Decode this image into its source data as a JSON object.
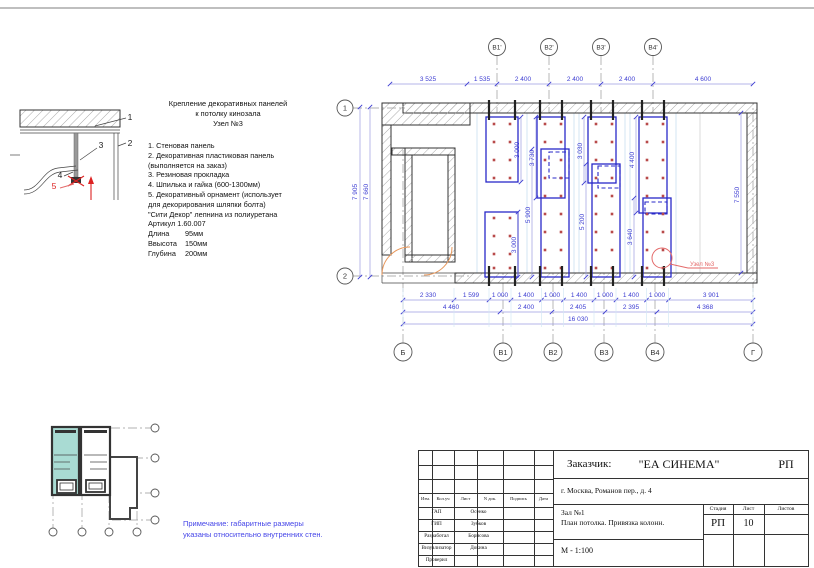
{
  "detail": {
    "title": [
      "Крепление декоративных панелей",
      "к потолку кинозала",
      "Узел №3"
    ],
    "items": [
      "1. Стеновая панель",
      "2. Декоративная пластиковая панель",
      "(выполняется на заказ)",
      "3. Резиновая прокладка",
      "4. Шпилька и гайка (600-1300мм)",
      "5. Декоративный орнамент (использует",
      "для декорирования шляпки болта)",
      "\"Сити Декор\" лепнина из полиуретана",
      "Артикул 1.60.007"
    ],
    "specs": [
      {
        "label": "Длина",
        "value": "95мм"
      },
      {
        "label": "Ввысота",
        "value": "150мм"
      },
      {
        "label": "Глубина",
        "value": "200мм"
      }
    ],
    "callouts": [
      "1",
      "2",
      "3",
      "4",
      "5"
    ]
  },
  "plan": {
    "axes_top": [
      "В1'",
      "В2'",
      "В3'",
      "В4'"
    ],
    "axes_bottom": [
      "Б",
      "В1",
      "В2",
      "В3",
      "В4",
      "Г"
    ],
    "axes_left": [
      "1",
      "2"
    ],
    "dims_top": [
      "3 525",
      "1 535",
      "2 400",
      "2 400",
      "2 400",
      "4 600"
    ],
    "dims_row1": [
      "2 330",
      "1 599",
      "1 000",
      "1 400",
      "1 000",
      "1 400",
      "1 000",
      "1 400",
      "1 000",
      "3 901"
    ],
    "dims_row2": [
      "4 460",
      "2 400",
      "2 405",
      "2 395",
      "4 368"
    ],
    "dim_total": "16 030",
    "dims_left": [
      "7 905",
      "7 660"
    ],
    "dim_right": "7 550",
    "dims_inner": [
      "3 000",
      "3 000",
      "3 730",
      "5 900",
      "3 030",
      "5 200",
      "4 400",
      "3 640"
    ],
    "node_label": "Узел №3"
  },
  "note": {
    "lines": [
      "Примечание: габаритные размеры",
      "указаны относительно внутренних стен."
    ]
  },
  "titleblock": {
    "customer_label": "Заказчик:",
    "customer_name": "\"ЕА СИНЕМА\"",
    "stage_top": "РП",
    "address": "г. Москва, Романов пер., д. 4",
    "object_line1": "Зал №1",
    "object_line2": "План потолка. Привязка колонн.",
    "scale": "М - 1:100",
    "header_cols": [
      "Изм.",
      "Кол.уч",
      "Лист",
      "N док.",
      "Подпись",
      "Дата"
    ],
    "roles": [
      {
        "role": "ГАП",
        "name": "Осенко"
      },
      {
        "role": "ГИП",
        "name": "Зубков"
      },
      {
        "role": "Разработал",
        "name": "Борисова"
      },
      {
        "role": "Визуализатор",
        "name": "Докина"
      },
      {
        "role": "Проверил",
        "name": ""
      }
    ],
    "stage_label": "Стадия",
    "sheet_label": "Лист",
    "sheets_label": "Листов",
    "stage_value": "РП",
    "sheet_value": "10",
    "sheets_value": ""
  },
  "colors": {
    "dim_blue": "#3c3cd2",
    "panel_blue": "#2828c8",
    "note_blue": "#4646e8",
    "accent_red": "#dd2222",
    "node_red": "#e46a6a",
    "highlight_teal": "#a9dbd3",
    "door_orange": "#e8975a"
  }
}
